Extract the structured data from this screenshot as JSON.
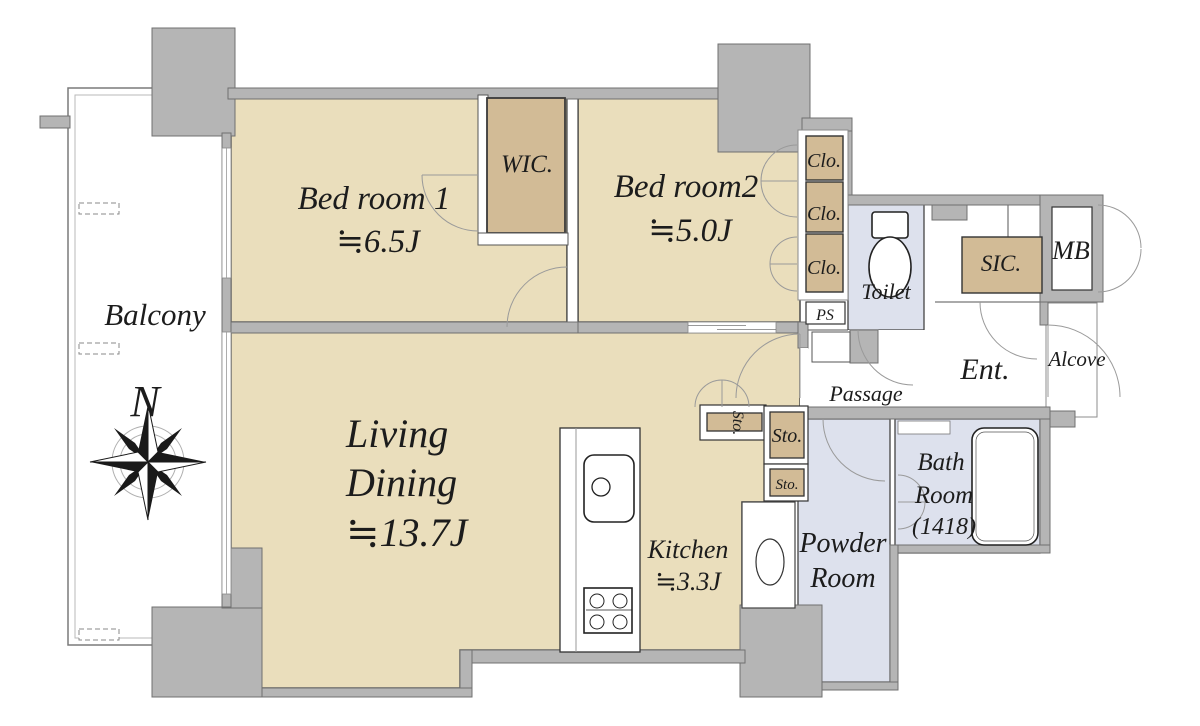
{
  "title": "Japanese apartment floor plan 2LDK",
  "colors": {
    "room_tan": "#EADEBC",
    "closet_tan": "#D2BB96",
    "wet_lavender": "#DDE1ED",
    "wall_gray": "#B5B5B5"
  },
  "compass": {
    "north_label": "N"
  },
  "rooms": {
    "balcony": {
      "label": "Balcony"
    },
    "bedroom1": {
      "name": "Bed room 1",
      "size": "≒6.5J"
    },
    "bedroom2": {
      "name": "Bed room2",
      "size": "≒5.0J"
    },
    "wic": {
      "label": "WIC."
    },
    "closets": {
      "clo1": "Clo.",
      "clo2": "Clo.",
      "clo3": "Clo."
    },
    "ps": {
      "label": "PS"
    },
    "toilet": {
      "label": "Toilet"
    },
    "sic": {
      "label": "SIC."
    },
    "mb": {
      "label": "MB"
    },
    "ent": {
      "label": "Ent."
    },
    "alcove": {
      "label": "Alcove"
    },
    "passage": {
      "label": "Passage"
    },
    "storage": {
      "sto_side": "Sto.",
      "sto_large": "Sto.",
      "sto_small": "Sto."
    },
    "living_dining": {
      "name_line1": "Living",
      "name_line2": "Dining",
      "size": "≒13.7J"
    },
    "kitchen": {
      "name": "Kitchen",
      "size": "≒3.3J"
    },
    "powder_room": {
      "name_line1": "Powder",
      "name_line2": "Room"
    },
    "bath_room": {
      "name_line1": "Bath",
      "name_line2": "Room",
      "size": "(1418)"
    }
  }
}
